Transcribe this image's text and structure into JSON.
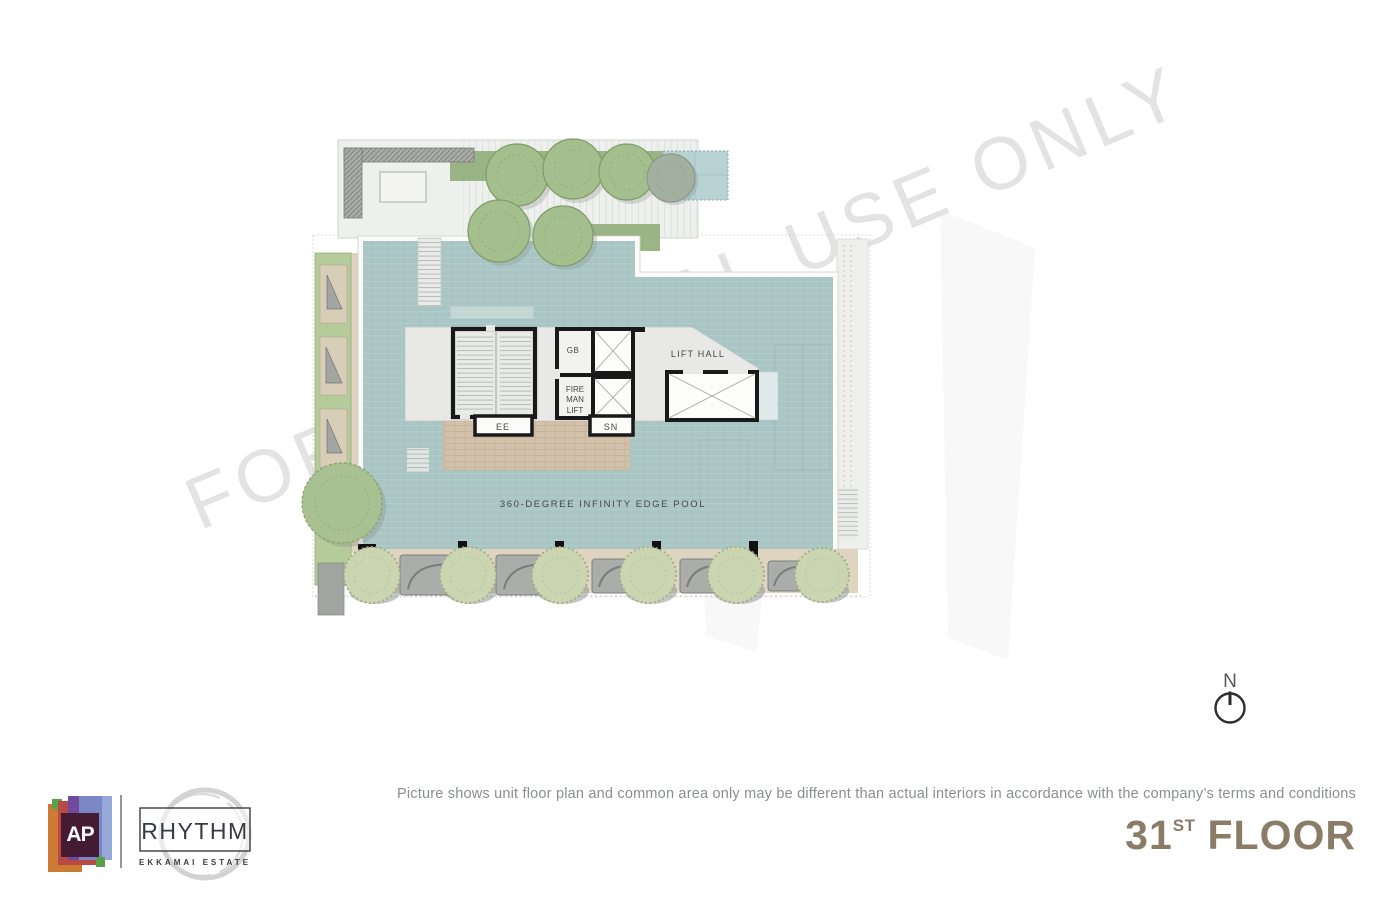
{
  "watermark": {
    "text": "FOR INTERNAL USE ONLY"
  },
  "floor_plan": {
    "labels": {
      "lift_hall": "LIFT HALL",
      "gb_room": "GB",
      "fireman_lift_line1": "FIRE",
      "fireman_lift_line2": "MAN",
      "fireman_lift_line3": "LIFT",
      "ee_room": "EE",
      "sn_room": "SN",
      "pool_caption": "360-DEGREE INFINITY EDGE POOL"
    },
    "colors": {
      "pool_water": "#a9c6c4",
      "deck_paving": "#eef0ee",
      "walkway_sand": "#ddd3bf",
      "planting_green": "#b5cb99",
      "structure_wall": "#191919"
    }
  },
  "compass": {
    "north_label": "N"
  },
  "footer": {
    "disclaimer": "Picture shows unit floor plan and common area only may be different than actual interiors in accordance with the company’s terms and conditions",
    "floor": {
      "number": "31",
      "ordinal": "ST",
      "word": "FLOOR",
      "color": "#8b7c68"
    }
  },
  "branding": {
    "ap_logo_monogram": "AP",
    "project_name": "RHYTHM",
    "project_location": "EKKAMAI ESTATE"
  }
}
